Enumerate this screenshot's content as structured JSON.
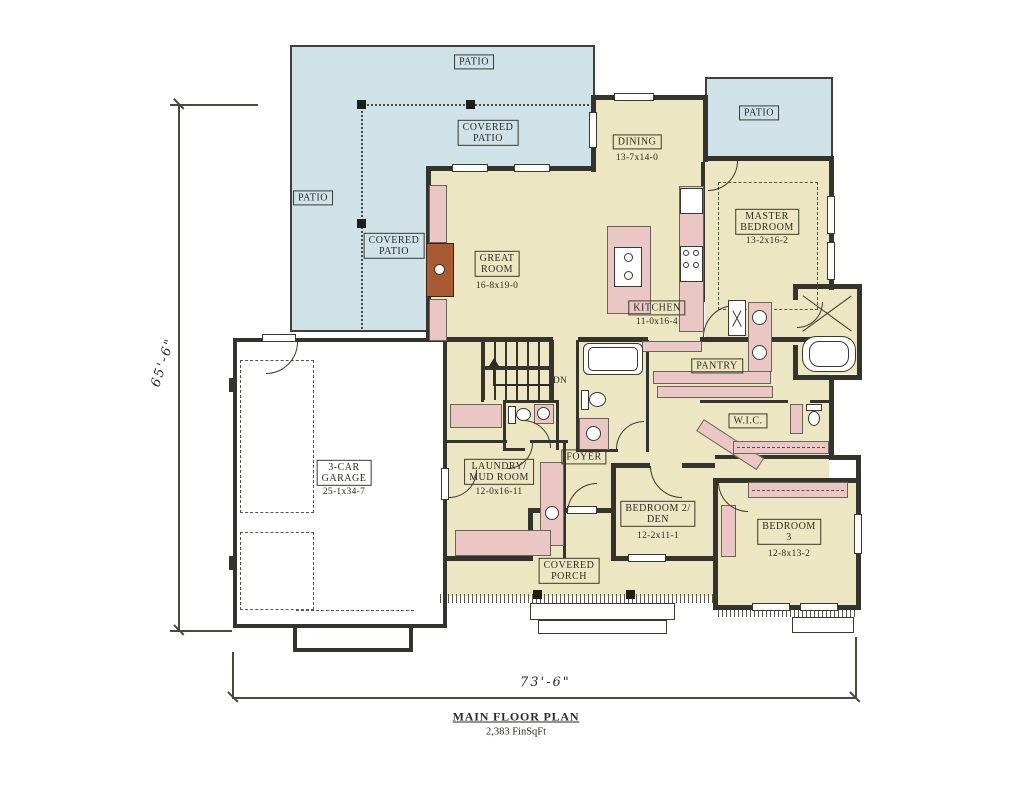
{
  "title_block": {
    "title": "MAIN FLOOR PLAN",
    "area": "2,383 FinSqFt"
  },
  "dimensions": {
    "left": "65'-6\"",
    "bottom": "73'-6\""
  },
  "outdoor": {
    "patio_top": "PATIO",
    "covered_patio_top": {
      "lines": [
        "COVERED",
        "PATIO"
      ]
    },
    "patio_left": "PATIO",
    "covered_patio_left": {
      "lines": [
        "COVERED",
        "PATIO"
      ]
    },
    "patio_right": "PATIO",
    "covered_porch": {
      "lines": [
        "COVERED",
        "PORCH"
      ]
    }
  },
  "rooms": {
    "dining": {
      "name": "DINING",
      "dims": "13-7x14-0"
    },
    "master": {
      "lines": [
        "MASTER",
        "BEDROOM"
      ],
      "dims": "13-2x16-2"
    },
    "great": {
      "lines": [
        "GREAT",
        "ROOM"
      ],
      "dims": "16-8x19-0"
    },
    "kitchen": {
      "name": "KITCHEN",
      "dims": "11-0x16-4"
    },
    "pantry": {
      "name": "PANTRY"
    },
    "wic": {
      "name": "W.I.C."
    },
    "garage": {
      "lines": [
        "3-CAR",
        "GARAGE"
      ],
      "dims": "25-1x34-7"
    },
    "laundry": {
      "lines": [
        "LAUNDRY/",
        "MUD ROOM"
      ],
      "dims": "12-0x16-11"
    },
    "foyer": {
      "name": "FOYER"
    },
    "bedroom2": {
      "lines": [
        "BEDROOM 2/",
        "DEN"
      ],
      "dims": "12-2x11-1"
    },
    "bedroom3": {
      "lines": [
        "BEDROOM",
        "3"
      ],
      "dims": "12-8x13-2"
    }
  },
  "annotations": {
    "stairs_dn": "DN"
  },
  "colors": {
    "patio": "#cfe2e8",
    "floor": "#ece6c3",
    "cabinet": "#eac6c4",
    "wall": "#35342c",
    "fireplace": "#a85a32"
  }
}
